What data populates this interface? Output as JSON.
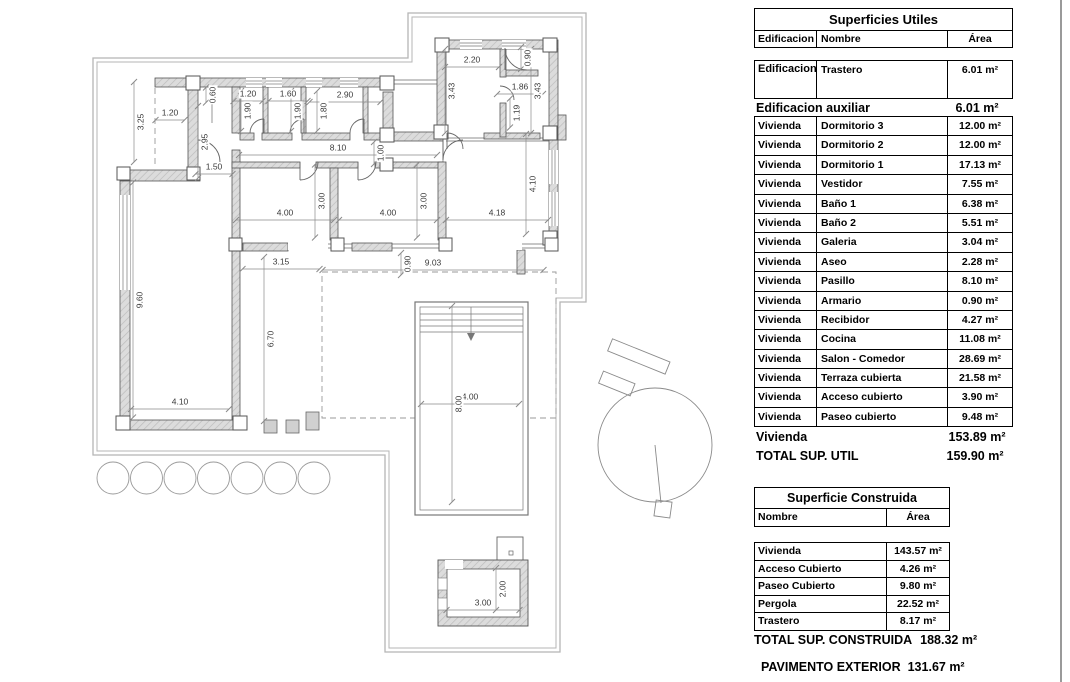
{
  "colors": {
    "wall_fill": "#dcdcdc",
    "wall_line": "#555555",
    "boundary": "#b5b5b5",
    "dim_text": "#3a3a3a",
    "table_border": "#000000",
    "background": "#ffffff"
  },
  "plan": {
    "dimensions": [
      {
        "label": "1.20",
        "x": 170,
        "y": 113,
        "rot": 0,
        "len": 29
      },
      {
        "label": "3.25",
        "x": 141,
        "y": 122,
        "rot": 1,
        "len": 80
      },
      {
        "label": "2.95",
        "x": 205,
        "y": 142,
        "rot": 1,
        "len": 72
      },
      {
        "label": "1.50",
        "x": 214,
        "y": 167,
        "rot": 0,
        "len": 37
      },
      {
        "label": "0.60",
        "x": 213,
        "y": 95,
        "rot": 1,
        "len": 15
      },
      {
        "label": "1.20",
        "x": 248,
        "y": 94,
        "rot": 0,
        "len": 29
      },
      {
        "label": "1.60",
        "x": 288,
        "y": 94,
        "rot": 0,
        "len": 39
      },
      {
        "label": "2.90",
        "x": 345,
        "y": 95,
        "rot": 0,
        "len": 71
      },
      {
        "label": "1.90",
        "x": 248,
        "y": 111,
        "rot": 1,
        "len": 40
      },
      {
        "label": "1.90",
        "x": 298,
        "y": 111,
        "rot": 1,
        "len": 40
      },
      {
        "label": "1.80",
        "x": 324,
        "y": 111,
        "rot": 1,
        "len": 40
      },
      {
        "label": "8.10",
        "x": 338,
        "y": 148,
        "rot": 0,
        "len": 198
      },
      {
        "label": "1.00",
        "x": 381,
        "y": 153,
        "rot": 1,
        "len": 22
      },
      {
        "label": "2.20",
        "x": 472,
        "y": 60,
        "rot": 0,
        "len": 54
      },
      {
        "label": "0.90",
        "x": 528,
        "y": 58,
        "rot": 1,
        "len": 22
      },
      {
        "label": "3.43",
        "x": 452,
        "y": 91,
        "rot": 1,
        "len": 84
      },
      {
        "label": "1.86",
        "x": 520,
        "y": 87,
        "rot": 0,
        "len": 46
      },
      {
        "label": "3.43",
        "x": 538,
        "y": 91,
        "rot": 1,
        "len": 84
      },
      {
        "label": "1.19",
        "x": 517,
        "y": 113,
        "rot": 1,
        "len": 29
      },
      {
        "label": "4.10",
        "x": 533,
        "y": 184,
        "rot": 1,
        "len": 100
      },
      {
        "label": "4.00",
        "x": 285,
        "y": 213,
        "rot": 0,
        "len": 98
      },
      {
        "label": "3.00",
        "x": 322,
        "y": 201,
        "rot": 1,
        "len": 73
      },
      {
        "label": "4.00",
        "x": 388,
        "y": 213,
        "rot": 0,
        "len": 98
      },
      {
        "label": "3.00",
        "x": 424,
        "y": 201,
        "rot": 1,
        "len": 73
      },
      {
        "label": "4.18",
        "x": 497,
        "y": 213,
        "rot": 0,
        "len": 102
      },
      {
        "label": "3.15",
        "x": 281,
        "y": 262,
        "rot": 0,
        "len": 77
      },
      {
        "label": "0.90",
        "x": 408,
        "y": 264,
        "rot": 1,
        "len": 22
      },
      {
        "label": "9.03",
        "x": 433,
        "y": 263,
        "rot": 0,
        "len": 221
      },
      {
        "label": "9.60",
        "x": 140,
        "y": 300,
        "rot": 1,
        "len": 235
      },
      {
        "label": "6.70",
        "x": 271,
        "y": 339,
        "rot": 1,
        "len": 164
      },
      {
        "label": "4.10",
        "x": 180,
        "y": 402,
        "rot": 0,
        "len": 98
      },
      {
        "label": "4.00",
        "x": 470,
        "y": 397,
        "rot": 0,
        "len": 98
      },
      {
        "label": "8.00",
        "x": 459,
        "y": 404,
        "rot": 1,
        "len": 196
      },
      {
        "label": "3.00",
        "x": 483,
        "y": 603,
        "rot": 0,
        "len": 73
      },
      {
        "label": "2.00",
        "x": 503,
        "y": 589,
        "rot": 1,
        "len": 42
      }
    ]
  },
  "tables": {
    "superficies_utiles": {
      "title": "Superficies Utiles",
      "columns": [
        "Edificacion",
        "Nombre",
        "Área"
      ],
      "aux_row": {
        "edificacion": "Edificacion auxiliar",
        "nombre": "Trastero",
        "area": "6.01 m²"
      },
      "aux_subtotal": {
        "label": "Edificacion auxiliar",
        "area": "6.01 m²"
      },
      "vivienda_rows": [
        {
          "edificacion": "Vivienda",
          "nombre": "Dormitorio 3",
          "area": "12.00 m²"
        },
        {
          "edificacion": "Vivienda",
          "nombre": "Dormitorio 2",
          "area": "12.00 m²"
        },
        {
          "edificacion": "Vivienda",
          "nombre": "Dormitorio 1",
          "area": "17.13 m²"
        },
        {
          "edificacion": "Vivienda",
          "nombre": "Vestidor",
          "area": "7.55 m²"
        },
        {
          "edificacion": "Vivienda",
          "nombre": "Baño 1",
          "area": "6.38 m²"
        },
        {
          "edificacion": "Vivienda",
          "nombre": "Baño 2",
          "area": "5.51 m²"
        },
        {
          "edificacion": "Vivienda",
          "nombre": "Galeria",
          "area": "3.04 m²"
        },
        {
          "edificacion": "Vivienda",
          "nombre": "Aseo",
          "area": "2.28 m²"
        },
        {
          "edificacion": "Vivienda",
          "nombre": "Pasillo",
          "area": "8.10 m²"
        },
        {
          "edificacion": "Vivienda",
          "nombre": "Armario",
          "area": "0.90 m²"
        },
        {
          "edificacion": "Vivienda",
          "nombre": "Recibidor",
          "area": "4.27 m²"
        },
        {
          "edificacion": "Vivienda",
          "nombre": "Cocina",
          "area": "11.08 m²"
        },
        {
          "edificacion": "Vivienda",
          "nombre": "Salon - Comedor",
          "area": "28.69 m²"
        },
        {
          "edificacion": "Vivienda",
          "nombre": "Terraza cubierta",
          "area": "21.58 m²"
        },
        {
          "edificacion": "Vivienda",
          "nombre": "Acceso cubierto",
          "area": "3.90 m²"
        },
        {
          "edificacion": "Vivienda",
          "nombre": "Paseo cubierto",
          "area": "9.48 m²"
        }
      ],
      "vivienda_subtotal": {
        "label": "Vivienda",
        "area": "153.89 m²"
      },
      "total": {
        "label": "TOTAL SUP. UTIL",
        "area": "159.90 m²"
      }
    },
    "superficie_construida": {
      "title": "Superficie Construida",
      "columns": [
        "Nombre",
        "Área"
      ],
      "rows": [
        {
          "nombre": "Vivienda",
          "area": "143.57 m²"
        },
        {
          "nombre": "Acceso Cubierto",
          "area": "4.26 m²"
        },
        {
          "nombre": "Paseo Cubierto",
          "area": "9.80 m²"
        },
        {
          "nombre": "Pergola",
          "area": "22.52 m²"
        },
        {
          "nombre": "Trastero",
          "area": "8.17 m²"
        }
      ],
      "total": {
        "label": "TOTAL SUP. CONSTRUIDA",
        "area": "188.32 m²"
      }
    },
    "pavimento_exterior": {
      "label": "PAVIMENTO EXTERIOR",
      "area": "131.67 m²"
    }
  }
}
